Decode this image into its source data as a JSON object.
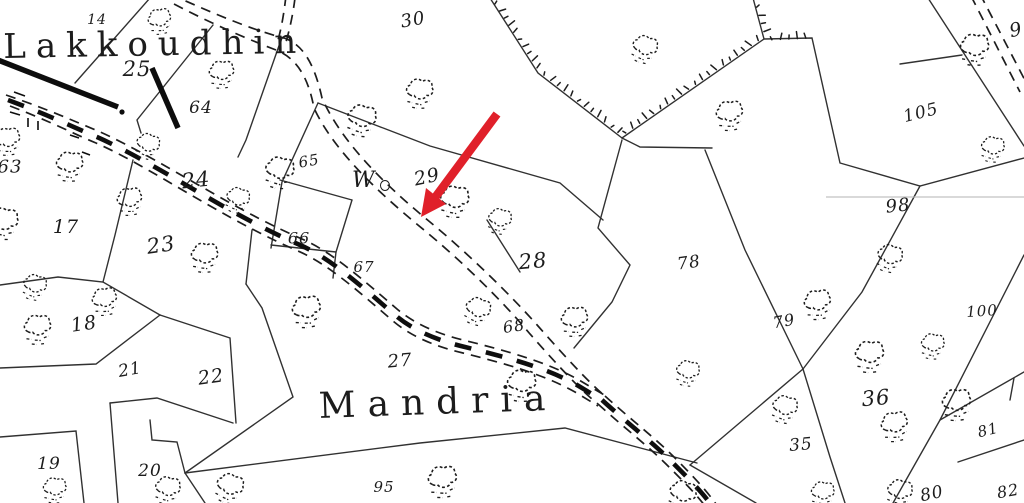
{
  "map": {
    "title": "cadastral survey map scan",
    "colors": {
      "ink": "#1d1d1d",
      "paper": "#ffffff",
      "annotation_red": "#e0202a"
    },
    "place_names": [
      {
        "id": "lakkoudhin",
        "text": "Lakkoudhin",
        "x": 3,
        "y": 27,
        "size": 34,
        "spacing": 10,
        "rotate": -1
      },
      {
        "id": "mandria",
        "text": "Mandria",
        "x": 318,
        "y": 386,
        "size": 36,
        "spacing": 12,
        "rotate": -2
      }
    ],
    "well": {
      "label": "W",
      "symbol": "well-circle",
      "x": 352,
      "y": 168,
      "size": 22
    },
    "parcel_numbers": [
      {
        "label": "14",
        "x": 97,
        "y": 20,
        "size": 14,
        "rot": 0
      },
      {
        "label": "25",
        "x": 137,
        "y": 69,
        "size": 21,
        "rot": 0
      },
      {
        "label": "64",
        "x": 201,
        "y": 108,
        "size": 17,
        "rot": 0
      },
      {
        "label": "63",
        "x": 10,
        "y": 167,
        "size": 18,
        "rot": 0
      },
      {
        "label": "65",
        "x": 309,
        "y": 161,
        "size": 15,
        "rot": -10
      },
      {
        "label": "24",
        "x": 196,
        "y": 180,
        "size": 21,
        "rot": -6
      },
      {
        "label": "17",
        "x": 66,
        "y": 227,
        "size": 19,
        "rot": 0
      },
      {
        "label": "23",
        "x": 161,
        "y": 245,
        "size": 21,
        "rot": -8
      },
      {
        "label": "66",
        "x": 299,
        "y": 238,
        "size": 16,
        "rot": 0
      },
      {
        "label": "67",
        "x": 364,
        "y": 267,
        "size": 15,
        "rot": 0
      },
      {
        "label": "29",
        "x": 427,
        "y": 177,
        "size": 19,
        "rot": -12
      },
      {
        "label": "28",
        "x": 533,
        "y": 261,
        "size": 21,
        "rot": -5
      },
      {
        "label": "68",
        "x": 514,
        "y": 326,
        "size": 16,
        "rot": -8
      },
      {
        "label": "78",
        "x": 689,
        "y": 263,
        "size": 17,
        "rot": -8
      },
      {
        "label": "79",
        "x": 784,
        "y": 321,
        "size": 16,
        "rot": -10
      },
      {
        "label": "27",
        "x": 400,
        "y": 361,
        "size": 18,
        "rot": -5
      },
      {
        "label": "18",
        "x": 84,
        "y": 324,
        "size": 19,
        "rot": -8
      },
      {
        "label": "21",
        "x": 130,
        "y": 370,
        "size": 17,
        "rot": -10
      },
      {
        "label": "22",
        "x": 211,
        "y": 377,
        "size": 19,
        "rot": -8
      },
      {
        "label": "19",
        "x": 49,
        "y": 464,
        "size": 17,
        "rot": 0
      },
      {
        "label": "20",
        "x": 150,
        "y": 471,
        "size": 17,
        "rot": 0
      },
      {
        "label": "95",
        "x": 384,
        "y": 487,
        "size": 15,
        "rot": 0
      },
      {
        "label": "30",
        "x": 413,
        "y": 20,
        "size": 18,
        "rot": -10
      },
      {
        "label": "105",
        "x": 921,
        "y": 113,
        "size": 17,
        "rot": -14
      },
      {
        "label": "98",
        "x": 898,
        "y": 206,
        "size": 18,
        "rot": -6
      },
      {
        "label": "100",
        "x": 982,
        "y": 311,
        "size": 15,
        "rot": -4
      },
      {
        "label": "36",
        "x": 876,
        "y": 398,
        "size": 21,
        "rot": -5
      },
      {
        "label": "35",
        "x": 801,
        "y": 445,
        "size": 17,
        "rot": -5
      },
      {
        "label": "80",
        "x": 932,
        "y": 494,
        "size": 17,
        "rot": -12
      },
      {
        "label": "81",
        "x": 988,
        "y": 430,
        "size": 15,
        "rot": -14
      },
      {
        "label": "82",
        "x": 1008,
        "y": 491,
        "size": 16,
        "rot": -10
      }
    ],
    "partial_labels": [
      {
        "label": "9",
        "x": 1016,
        "y": 30,
        "size": 19,
        "rot": -12
      }
    ],
    "trees": [
      [
        160,
        20
      ],
      [
        222,
        73
      ],
      [
        420,
        92
      ],
      [
        362,
        119
      ],
      [
        148,
        145
      ],
      [
        8,
        140
      ],
      [
        70,
        165
      ],
      [
        280,
        171
      ],
      [
        238,
        199
      ],
      [
        130,
        200
      ],
      [
        205,
        256
      ],
      [
        4,
        222
      ],
      [
        35,
        286
      ],
      [
        105,
        300
      ],
      [
        38,
        328
      ],
      [
        455,
        200
      ],
      [
        500,
        220
      ],
      [
        478,
        310
      ],
      [
        575,
        320
      ],
      [
        522,
        384
      ],
      [
        688,
        372
      ],
      [
        645,
        48
      ],
      [
        730,
        114
      ],
      [
        975,
        48
      ],
      [
        993,
        148
      ],
      [
        890,
        257
      ],
      [
        818,
        303
      ],
      [
        870,
        355
      ],
      [
        933,
        345
      ],
      [
        785,
        408
      ],
      [
        895,
        425
      ],
      [
        957,
        403
      ],
      [
        823,
        493
      ],
      [
        900,
        492
      ],
      [
        230,
        487
      ],
      [
        443,
        480
      ],
      [
        55,
        489
      ],
      [
        168,
        489
      ],
      [
        683,
        494
      ],
      [
        307,
        310
      ]
    ],
    "annotation_arrow": {
      "color": "#e0202a",
      "from": [
        497,
        114
      ],
      "to": [
        434,
        199
      ],
      "tip": [
        421,
        217
      ]
    }
  }
}
